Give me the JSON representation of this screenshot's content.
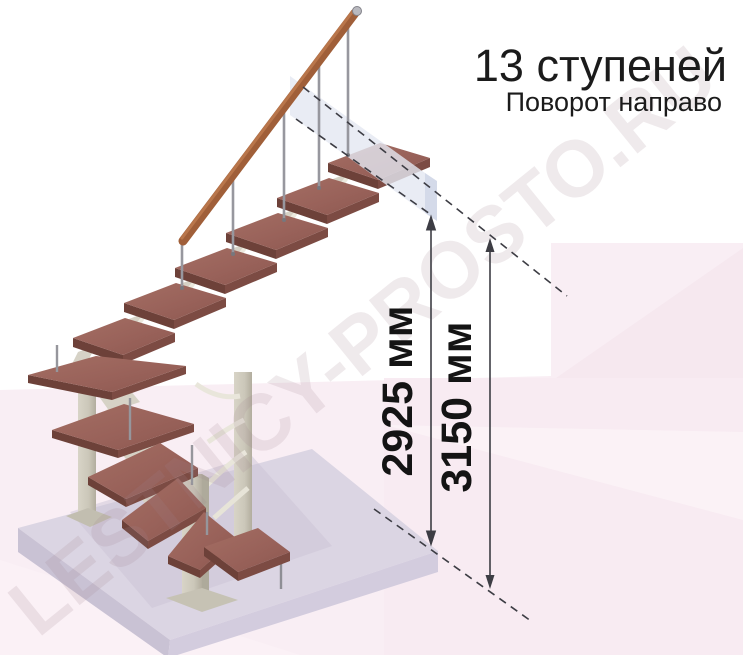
{
  "annotation": {
    "title": "13 ступеней",
    "subtitle": "Поворот направо",
    "dimension_labels": [
      "2925 мм",
      "3150 мм"
    ]
  },
  "watermark": "LESTNICY-PROSTO.RU",
  "colors": {
    "background": "#ffffff",
    "background_pink": "#f9eef4",
    "background_pink_deep": "#f5e7ee",
    "background_pink_light": "#fcf4f8",
    "tread_top": "#9a635b",
    "tread_front": "#7c4b43",
    "tread_side": "#6d4139",
    "handrail": "#a05f39",
    "handrail_highlight": "#c07c50",
    "metal_support": "#cdc9bb",
    "metal_support_dark": "#b3ae9f",
    "branch_support": "#eceadf",
    "baluster": "#97979e",
    "floor_slab_top": "#dbd5e3",
    "floor_slab_left": "#c9c2d4",
    "floor_slab_front": "#d3ccde",
    "landing_band": "#e4e7f1",
    "landing_band_side": "#cdd3e5",
    "dimension_line": "#3d3d44",
    "text": "#1b1b1b"
  }
}
